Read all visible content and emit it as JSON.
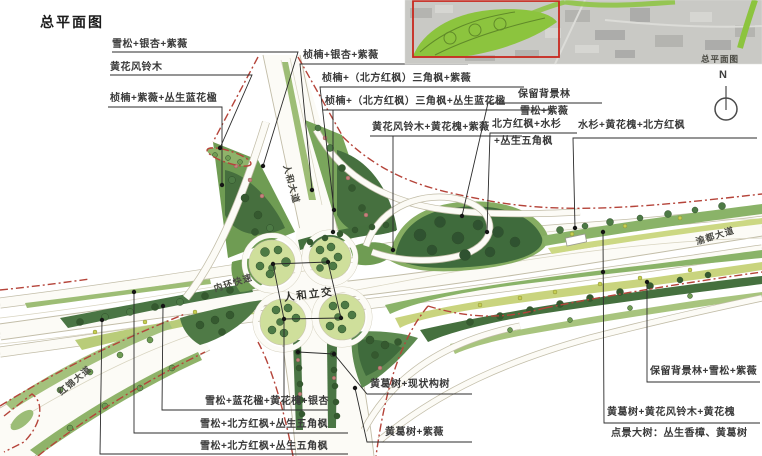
{
  "title": "总平面图",
  "inset": {
    "caption": "总平面图"
  },
  "north": {
    "label": "N"
  },
  "roads": {
    "renhe": "人和大道",
    "neihuan": "内环快速",
    "hongjin": "红锦大道",
    "yudu": "渝都大道",
    "interchange": "人和立交"
  },
  "annotations": [
    {
      "text": "雪松+银杏+紫薇"
    },
    {
      "text": "黄花风铃木"
    },
    {
      "text": "桢楠+紫薇+丛生蓝花楹"
    },
    {
      "text": "桢楠+银杏+紫薇"
    },
    {
      "text": "桢楠+（北方红枫）三角枫+紫薇"
    },
    {
      "text": "桢楠+（北方红枫）三角枫+丛生蓝花楹"
    },
    {
      "text": "黄花风铃木+黄花槐+紫薇"
    },
    {
      "text": "保留背景林"
    },
    {
      "text": "雪松+紫薇"
    },
    {
      "text": "北方红枫+水杉"
    },
    {
      "text": "+丛生五角枫"
    },
    {
      "text": "水杉+黄花槐+北方红枫"
    },
    {
      "text": "雪松+蓝花楹+黄花槐+银杏"
    },
    {
      "text": "雪松+北方红枫+丛生五角枫"
    },
    {
      "text": "雪松+北方红枫+丛生五角枫"
    },
    {
      "text": "黄葛树+现状构树"
    },
    {
      "text": "黄葛树+紫薇"
    },
    {
      "text": "保留背景林+雪松+紫薇"
    },
    {
      "text": "黄葛树+黄花风铃木+黄花槐"
    },
    {
      "text": "点景大树：丛生香樟、黄葛树"
    }
  ],
  "colors": {
    "boundary_red": "#b5443a",
    "leader": "#2b2b2b",
    "road_white": "#fcfbf6",
    "road_edge": "#c2bda8",
    "green_dark": "#3f6b3c",
    "green_mid": "#6f9c53",
    "green_light": "#cfdf9b",
    "green_yellow": "#c9d47e",
    "inset_green": "#8cc43e",
    "inset_red": "#c8281e"
  }
}
